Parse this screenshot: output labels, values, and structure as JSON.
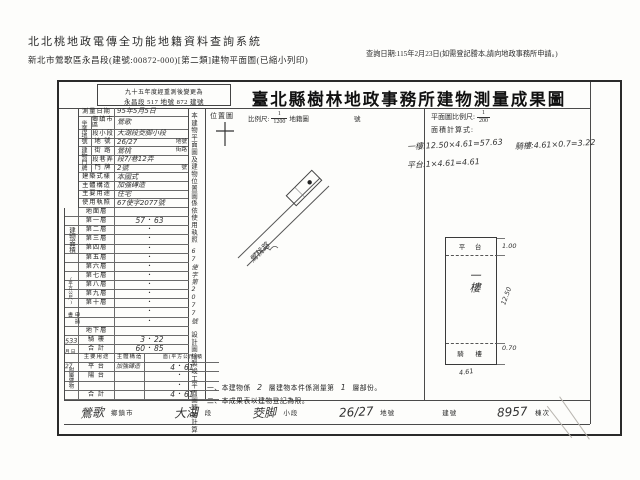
{
  "colors": {
    "paper": "#fdfdfb",
    "ink": "#2b2b2b",
    "hand": "#333333",
    "line": "#4a4a4a"
  },
  "page_header": {
    "system_title": "北北桃地政電傳全功能地籍資料查詢系統",
    "print_subtitle": "新北市鶯歌區永昌段(建號:00872-000)[第二類]建物平面圖(已縮小列印)",
    "query_note": "查詢日期:115年2月23日(如需登記謄本,請向地政事務所申請。)"
  },
  "doc": {
    "renumber_line1": "九十五年度經重測後變更為",
    "renumber_line2": "永昌段 517 地號 872 建號",
    "title": "臺北縣樹林地政事務所建物測量成果圖",
    "survey_label": "測量日期",
    "survey_value": "95年5月5日",
    "map": {
      "label": "位置圖",
      "scale_label": "比例尺:",
      "num": "1",
      "den": "1200",
      "type": "地籍圖",
      "sheet": "號",
      "road": "鶯桃路"
    },
    "plan": {
      "scale_label": "平面圖比例尺:",
      "num": "1",
      "den": "200",
      "calc_label": "面積計算式:",
      "calcs": [
        {
          "t": "一樓:12.50×4.61=57.63"
        },
        {
          "t": "騎樓:4.61×0.7=3.22"
        },
        {
          "t": "平台:1×4.61=4.61"
        }
      ],
      "top_label": "平 台",
      "main_label": "一樓",
      "strip_label": "騎  樓",
      "dim_top": "1.00",
      "dim_side": "12.50",
      "dim_strip": "0.70",
      "dim_width": "4.61"
    },
    "vnote": {
      "p1": "本建物平面圖及建物位置圖係依使用執照",
      "hand": "67使字第2077號",
      "p2": "設計圖繪製竣工平面圖轉繪計算"
    },
    "form": {
      "site_group": "坐落地號",
      "site_rows": [
        {
          "label": "鄉鎮市區",
          "value": "鶯歌",
          "suffix": ""
        },
        {
          "label": "段小段",
          "value": "大湖段茭脚小段",
          "suffix": ""
        },
        {
          "label": "地 號",
          "value": "26/27",
          "suffix": "地號"
        }
      ],
      "door_group": "建物門牌",
      "door_rows": [
        {
          "label": "街 路",
          "value": "鶯桃",
          "suffix": "街路"
        },
        {
          "label": "段巷弄",
          "value": "段7/巷12弄",
          "suffix": ""
        },
        {
          "label": "門 牌",
          "value": "2號",
          "suffix": "號"
        }
      ],
      "attr_rows": [
        {
          "label": "建築式樣",
          "value": "本國式"
        },
        {
          "label": "主體構造",
          "value": "加強磚造"
        },
        {
          "label": "主要用途",
          "value": "住宅"
        },
        {
          "label": "使用執照",
          "value": "67使字2077號"
        }
      ],
      "area_group": "建物面積",
      "area_unit": "(平方公尺)",
      "floors": [
        {
          "label": "地面層",
          "l": "",
          "dot": "",
          "r": ""
        },
        {
          "label": "第一層",
          "l": "57",
          "dot": "・",
          "r": "63"
        },
        {
          "label": "第二層",
          "l": "",
          "dot": "・",
          "r": ""
        },
        {
          "label": "第三層",
          "l": "",
          "dot": "・",
          "r": ""
        },
        {
          "label": "第四層",
          "l": "",
          "dot": "・",
          "r": ""
        },
        {
          "label": "第五層",
          "l": "",
          "dot": "・",
          "r": ""
        },
        {
          "label": "第六層",
          "l": "",
          "dot": "・",
          "r": ""
        },
        {
          "label": "第七層",
          "l": "",
          "dot": "・",
          "r": ""
        },
        {
          "label": "第八層",
          "l": "",
          "dot": "・",
          "r": ""
        },
        {
          "label": "第九層",
          "l": "",
          "dot": "・",
          "r": ""
        },
        {
          "label": "第十層",
          "l": "",
          "dot": "・",
          "r": ""
        },
        {
          "label": "",
          "l": "",
          "dot": "・",
          "r": ""
        },
        {
          "label": "",
          "l": "",
          "dot": "・",
          "r": ""
        },
        {
          "label": "地下層",
          "l": "",
          "dot": "",
          "r": ""
        },
        {
          "label": "騎 樓",
          "l": "3",
          "dot": "・",
          "r": "22"
        },
        {
          "label": "合 計",
          "l": "60",
          "dot": "・",
          "r": "85"
        }
      ],
      "application": {
        "group": "申請書",
        "hand_no": "533",
        "date_units": "月 日",
        "hand_date": "27"
      },
      "annex_group": "附屬建物",
      "annex_header": {
        "use": "主要用途",
        "struct": "主體構造",
        "area": "面(平方公尺)積"
      },
      "annex_rows": [
        {
          "use": "平 台",
          "struct": "加強磚造",
          "l": "4",
          "dot": "・",
          "r": "61"
        },
        {
          "use": "陽 台",
          "struct": "",
          "l": "",
          "dot": "・",
          "r": ""
        },
        {
          "use": "",
          "struct": "",
          "l": "",
          "dot": "・",
          "r": ""
        },
        {
          "use": "合 計",
          "struct": "",
          "l": "4",
          "dot": "・",
          "r": "61"
        }
      ]
    },
    "notes": {
      "n1_pre": "一、本建物係",
      "n1_h1": "2",
      "n1_mid": "層建物本件係測量第",
      "n1_h2": "1",
      "n1_post": "層部份。",
      "n2": "二、本成果表以建物登記為限。"
    },
    "strip": [
      {
        "hand": "鶯歌",
        "label": "鄉鎮市"
      },
      {
        "hand": "大湖",
        "label": "段"
      },
      {
        "hand": "茭脚",
        "label": "小段"
      },
      {
        "hand": "26/27",
        "label": "地號"
      },
      {
        "hand": "",
        "label": "建號"
      },
      {
        "hand": "8957",
        "label": "棟次"
      }
    ]
  }
}
